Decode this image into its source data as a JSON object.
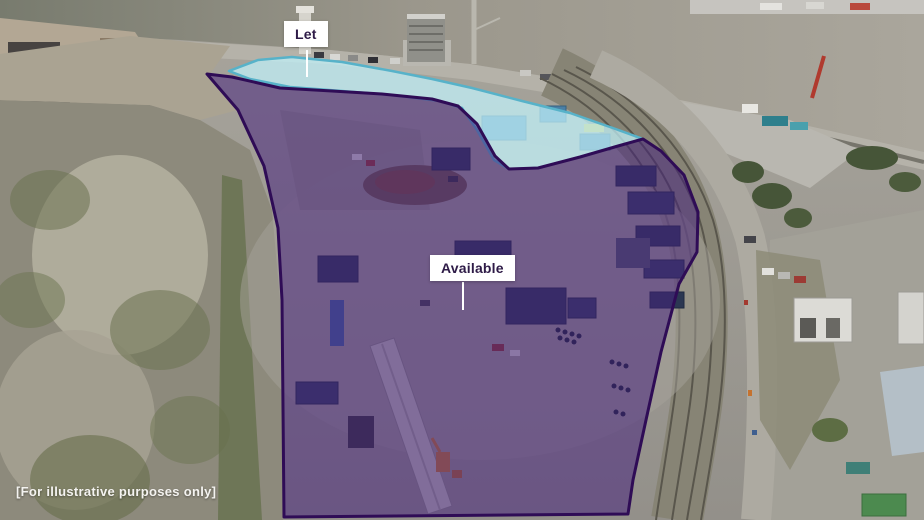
{
  "overlays": {
    "let": {
      "label": "Let",
      "fill": "#c2f2fb",
      "border": "#57b2c9"
    },
    "available": {
      "label": "Available",
      "fill": "#45217d",
      "border": "#2f0c56"
    }
  },
  "footer": {
    "disclaimer": "[For illustrative purposes only]"
  },
  "label_style": {
    "text_color": "#2e1b47",
    "background": "#ffffff",
    "leader_color": "#ffffff"
  }
}
